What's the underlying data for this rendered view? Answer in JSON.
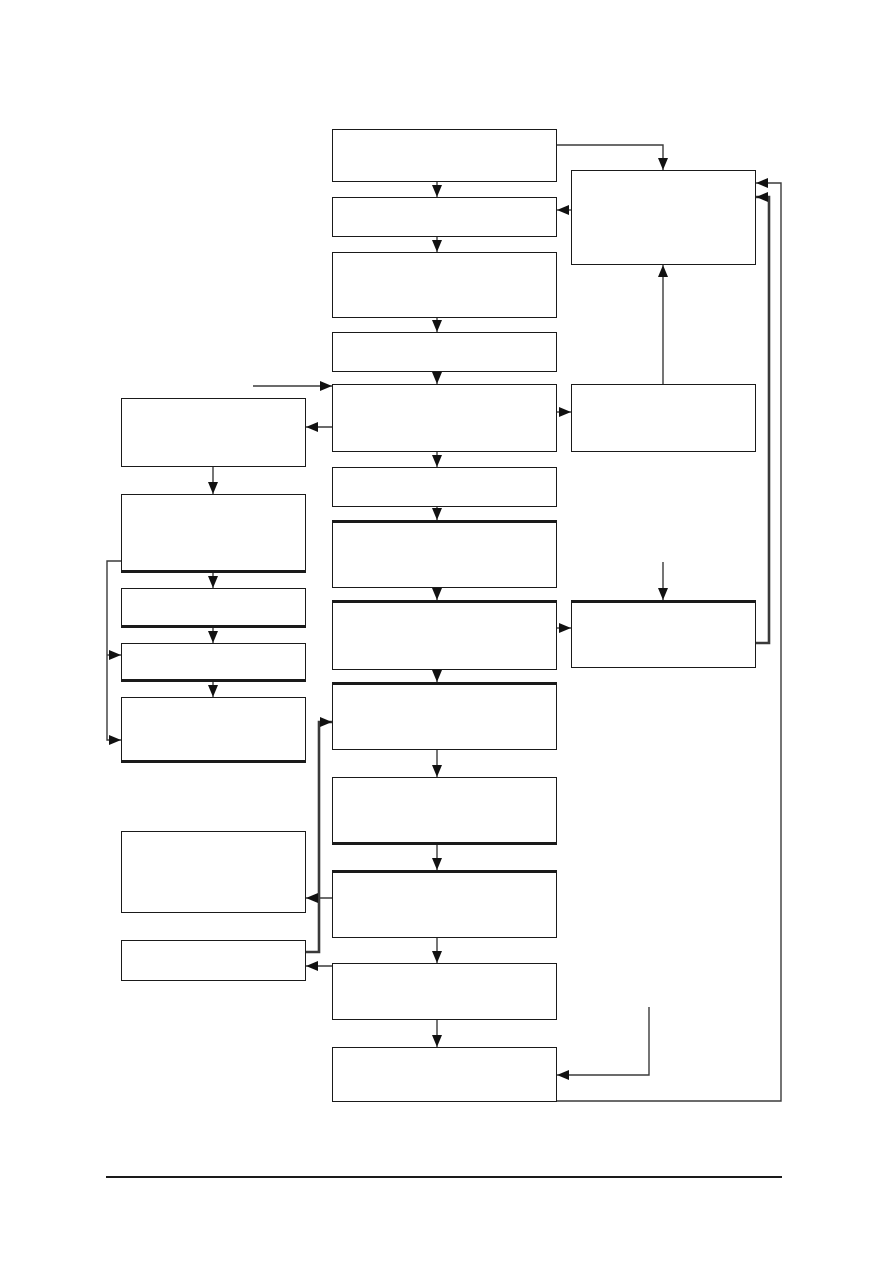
{
  "page": {
    "width": 893,
    "height": 1263,
    "background": "#ffffff"
  },
  "diagram": {
    "description": "Flowchart of unlabeled (empty) rectangular process boxes connected by arrows; a main vertical sequence in the center column, a secondary column of boxes on the left, three boxes on the right, feedback loop lines on the far right, and a horizontal footer rule near the bottom of the page. No text appears anywhere in the image.",
    "styles": {
      "box_fill": "#ffffff",
      "box_border_color": "#1a1a1a",
      "box_border_width": 1.5,
      "box_border_thick_width": 3,
      "edge_color": "#3a3a3a",
      "edge_width": 1.4,
      "edge_thick_width": 2.6,
      "arrow_color": "#111111",
      "footer_rule_color": "#1a1a1a"
    },
    "nodes": [
      {
        "id": "center-1",
        "label": "",
        "x": 332,
        "y": 129,
        "w": 225,
        "h": 53,
        "thick": ""
      },
      {
        "id": "center-2",
        "label": "",
        "x": 332,
        "y": 197,
        "w": 225,
        "h": 40,
        "thick": ""
      },
      {
        "id": "center-3",
        "label": "",
        "x": 332,
        "y": 252,
        "w": 225,
        "h": 66,
        "thick": ""
      },
      {
        "id": "center-4",
        "label": "",
        "x": 332,
        "y": 332,
        "w": 225,
        "h": 40,
        "thick": ""
      },
      {
        "id": "center-5",
        "label": "",
        "x": 332,
        "y": 384,
        "w": 225,
        "h": 68,
        "thick": ""
      },
      {
        "id": "center-6",
        "label": "",
        "x": 332,
        "y": 467,
        "w": 225,
        "h": 40,
        "thick": ""
      },
      {
        "id": "center-7",
        "label": "",
        "x": 332,
        "y": 520,
        "w": 225,
        "h": 68,
        "thick": "top"
      },
      {
        "id": "center-8",
        "label": "",
        "x": 332,
        "y": 600,
        "w": 225,
        "h": 70,
        "thick": "top"
      },
      {
        "id": "center-9",
        "label": "",
        "x": 332,
        "y": 682,
        "w": 225,
        "h": 68,
        "thick": "top"
      },
      {
        "id": "center-10",
        "label": "",
        "x": 332,
        "y": 777,
        "w": 225,
        "h": 68,
        "thick": "bottom"
      },
      {
        "id": "center-11",
        "label": "",
        "x": 332,
        "y": 870,
        "w": 225,
        "h": 68,
        "thick": "top"
      },
      {
        "id": "center-12",
        "label": "",
        "x": 332,
        "y": 963,
        "w": 225,
        "h": 57,
        "thick": ""
      },
      {
        "id": "center-13",
        "label": "",
        "x": 332,
        "y": 1047,
        "w": 225,
        "h": 55,
        "thick": ""
      },
      {
        "id": "left-1",
        "label": "",
        "x": 121,
        "y": 398,
        "w": 185,
        "h": 69,
        "thick": ""
      },
      {
        "id": "left-2",
        "label": "",
        "x": 121,
        "y": 494,
        "w": 185,
        "h": 79,
        "thick": "bottom"
      },
      {
        "id": "left-3",
        "label": "",
        "x": 121,
        "y": 588,
        "w": 185,
        "h": 40,
        "thick": "bottom"
      },
      {
        "id": "left-4",
        "label": "",
        "x": 121,
        "y": 643,
        "w": 185,
        "h": 39,
        "thick": "bottom"
      },
      {
        "id": "left-5",
        "label": "",
        "x": 121,
        "y": 697,
        "w": 185,
        "h": 66,
        "thick": "bottom"
      },
      {
        "id": "left-6",
        "label": "",
        "x": 121,
        "y": 831,
        "w": 185,
        "h": 82,
        "thick": ""
      },
      {
        "id": "left-7",
        "label": "",
        "x": 121,
        "y": 940,
        "w": 185,
        "h": 41,
        "thick": ""
      },
      {
        "id": "right-1",
        "label": "",
        "x": 571,
        "y": 170,
        "w": 185,
        "h": 95,
        "thick": ""
      },
      {
        "id": "right-2",
        "label": "",
        "x": 571,
        "y": 384,
        "w": 185,
        "h": 68,
        "thick": ""
      },
      {
        "id": "right-3",
        "label": "",
        "x": 571,
        "y": 600,
        "w": 185,
        "h": 68,
        "thick": "top"
      }
    ],
    "edges": [
      {
        "id": "c1-c2",
        "points": [
          [
            437,
            182
          ],
          [
            437,
            197
          ]
        ],
        "arrow": true,
        "weight": "thin"
      },
      {
        "id": "c2-c3",
        "points": [
          [
            437,
            237
          ],
          [
            437,
            252
          ]
        ],
        "arrow": true,
        "weight": "thin"
      },
      {
        "id": "c3-c4",
        "points": [
          [
            437,
            318
          ],
          [
            437,
            332
          ]
        ],
        "arrow": true,
        "weight": "thin"
      },
      {
        "id": "c4-c5",
        "points": [
          [
            437,
            372
          ],
          [
            437,
            384
          ]
        ],
        "arrow": true,
        "weight": "thin"
      },
      {
        "id": "c5-c6",
        "points": [
          [
            437,
            452
          ],
          [
            437,
            467
          ]
        ],
        "arrow": true,
        "weight": "thin"
      },
      {
        "id": "c6-c7",
        "points": [
          [
            437,
            507
          ],
          [
            437,
            520
          ]
        ],
        "arrow": true,
        "weight": "thin"
      },
      {
        "id": "c7-c8",
        "points": [
          [
            437,
            588
          ],
          [
            437,
            600
          ]
        ],
        "arrow": true,
        "weight": "thin"
      },
      {
        "id": "c8-c9",
        "points": [
          [
            437,
            670
          ],
          [
            437,
            682
          ]
        ],
        "arrow": true,
        "weight": "thin"
      },
      {
        "id": "c9-c10",
        "points": [
          [
            437,
            750
          ],
          [
            437,
            777
          ]
        ],
        "arrow": true,
        "weight": "thin"
      },
      {
        "id": "c10-c11",
        "points": [
          [
            437,
            845
          ],
          [
            437,
            870
          ]
        ],
        "arrow": true,
        "weight": "thin"
      },
      {
        "id": "c11-c12",
        "points": [
          [
            437,
            938
          ],
          [
            437,
            963
          ]
        ],
        "arrow": true,
        "weight": "thin"
      },
      {
        "id": "c12-c13",
        "points": [
          [
            437,
            1020
          ],
          [
            437,
            1047
          ]
        ],
        "arrow": true,
        "weight": "thin"
      },
      {
        "id": "c1-r1",
        "points": [
          [
            557,
            145
          ],
          [
            663,
            145
          ],
          [
            663,
            170
          ]
        ],
        "arrow": true,
        "weight": "thin"
      },
      {
        "id": "r1-c2",
        "points": [
          [
            571,
            210
          ],
          [
            557,
            210
          ]
        ],
        "arrow": true,
        "weight": "thin"
      },
      {
        "id": "r2-r1",
        "points": [
          [
            663,
            384
          ],
          [
            663,
            265
          ]
        ],
        "arrow": true,
        "weight": "thin"
      },
      {
        "id": "c5-r2",
        "points": [
          [
            557,
            412
          ],
          [
            571,
            412
          ]
        ],
        "arrow": true,
        "weight": "thin"
      },
      {
        "id": "c5-l1",
        "points": [
          [
            332,
            427
          ],
          [
            306,
            427
          ]
        ],
        "arrow": true,
        "weight": "thin"
      },
      {
        "id": "entry-c5",
        "points": [
          [
            253,
            386
          ],
          [
            332,
            386
          ]
        ],
        "arrow": true,
        "weight": "thin"
      },
      {
        "id": "c8-r3",
        "points": [
          [
            557,
            628
          ],
          [
            571,
            628
          ]
        ],
        "arrow": true,
        "weight": "thin"
      },
      {
        "id": "r3-r1-loop",
        "points": [
          [
            756,
            643
          ],
          [
            769,
            643
          ],
          [
            769,
            197
          ],
          [
            756,
            197
          ]
        ],
        "arrow": true,
        "weight": "thick"
      },
      {
        "id": "c13-r1-loop",
        "points": [
          [
            557,
            1101
          ],
          [
            781,
            1101
          ],
          [
            781,
            183
          ],
          [
            756,
            183
          ]
        ],
        "arrow": true,
        "weight": "thin"
      },
      {
        "id": "l2-l5-branch",
        "points": [
          [
            121,
            561
          ],
          [
            107,
            561
          ],
          [
            107,
            740
          ],
          [
            121,
            740
          ]
        ],
        "arrow": true,
        "weight": "thin"
      },
      {
        "id": "branch-l4",
        "points": [
          [
            107,
            655
          ],
          [
            121,
            655
          ]
        ],
        "arrow": true,
        "weight": "thin"
      },
      {
        "id": "l1-l2",
        "points": [
          [
            213,
            467
          ],
          [
            213,
            494
          ]
        ],
        "arrow": true,
        "weight": "thin"
      },
      {
        "id": "l2-l3",
        "points": [
          [
            213,
            573
          ],
          [
            213,
            588
          ]
        ],
        "arrow": true,
        "weight": "thin"
      },
      {
        "id": "l3-l4",
        "points": [
          [
            213,
            628
          ],
          [
            213,
            643
          ]
        ],
        "arrow": true,
        "weight": "thin"
      },
      {
        "id": "l4-l5",
        "points": [
          [
            213,
            682
          ],
          [
            213,
            697
          ]
        ],
        "arrow": true,
        "weight": "thin"
      },
      {
        "id": "l7-c9-loop",
        "points": [
          [
            306,
            952
          ],
          [
            319,
            952
          ],
          [
            319,
            722
          ],
          [
            332,
            722
          ]
        ],
        "arrow": true,
        "weight": "thick"
      },
      {
        "id": "c11-l6",
        "points": [
          [
            332,
            898
          ],
          [
            306,
            898
          ]
        ],
        "arrow": true,
        "weight": "thin"
      },
      {
        "id": "c12-l7",
        "points": [
          [
            332,
            966
          ],
          [
            306,
            966
          ]
        ],
        "arrow": true,
        "weight": "thin"
      },
      {
        "id": "entry-c13",
        "points": [
          [
            649,
            1007
          ],
          [
            649,
            1075
          ],
          [
            557,
            1075
          ]
        ],
        "arrow": true,
        "weight": "thin"
      },
      {
        "id": "entry-r3",
        "points": [
          [
            663,
            562
          ],
          [
            663,
            600
          ]
        ],
        "arrow": true,
        "weight": "thin"
      }
    ],
    "footer_rule": {
      "x": 106,
      "y": 1176,
      "width": 676,
      "height": 2
    }
  }
}
